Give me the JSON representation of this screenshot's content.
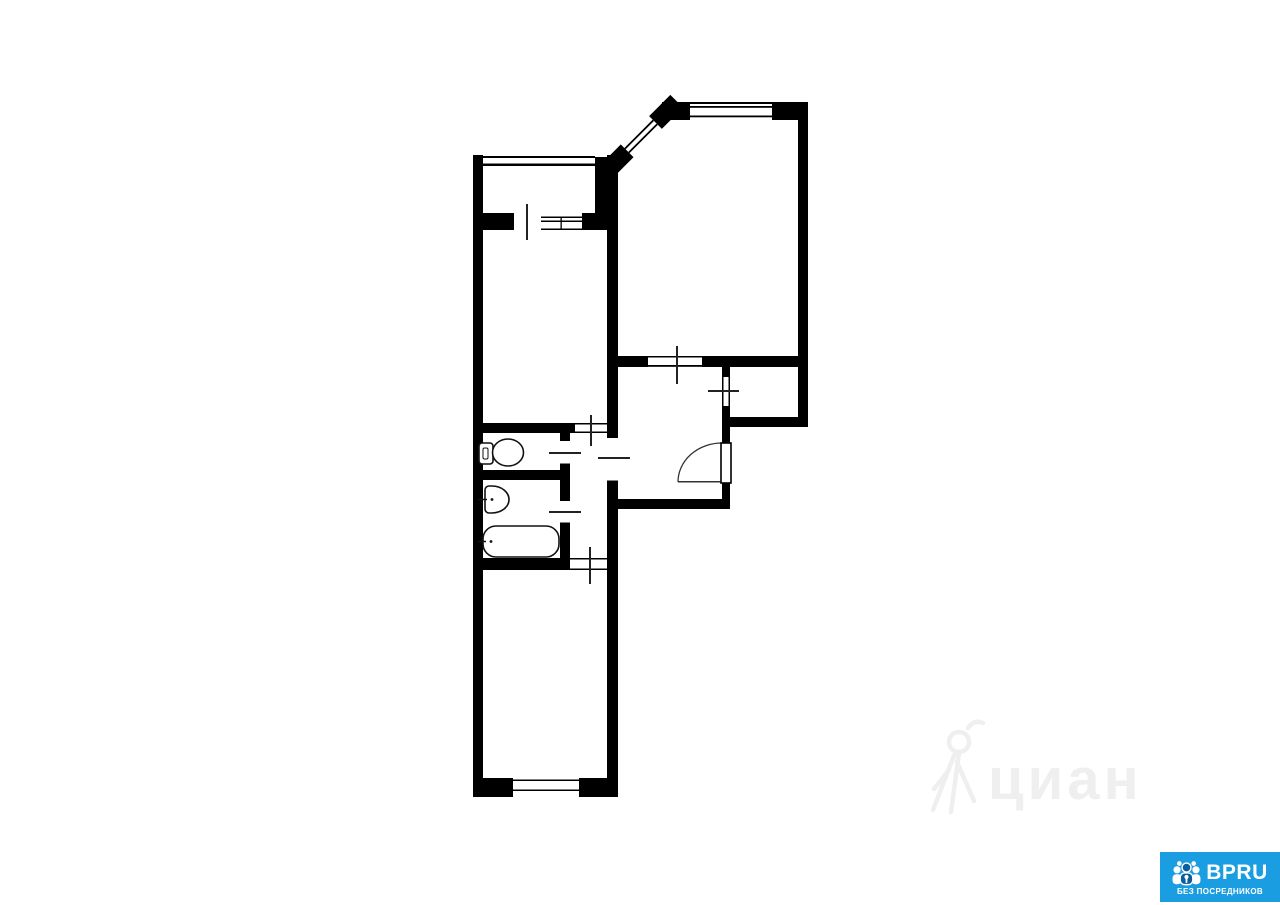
{
  "watermark": {
    "text": "циан",
    "color": "#efefef",
    "icon": "cian-walking-person-icon"
  },
  "brand_badge": {
    "name": "BPRU",
    "tagline": "БЕЗ ПОСРЕДНИКОВ",
    "background_color": "#1b9de2",
    "text_color": "#ffffff",
    "icon": "bpru-people-group-icon",
    "icon_accent_color": "#0c5d9c"
  },
  "floorplan": {
    "wall_color": "#000000",
    "tick_color": "#222222",
    "fixtures": [
      "toilet",
      "sink",
      "bathtub"
    ],
    "features": [
      "balcony-with-door-and-window",
      "corner-bay-window-45deg",
      "top-window",
      "entrance-door-with-swing-arc",
      "niche-window",
      "bottom-window"
    ]
  }
}
